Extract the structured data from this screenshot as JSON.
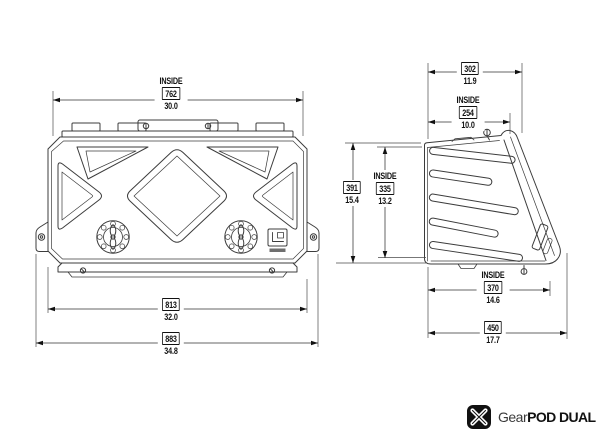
{
  "canvas": {
    "width": 600,
    "height": 448,
    "background": "#ffffff"
  },
  "colors": {
    "line": "#3c3c3c",
    "dim_line": "#333333",
    "text": "#111111"
  },
  "dimensions": {
    "front_inside_width": {
      "prefix": "INSIDE",
      "mm": "762",
      "in": "30.0"
    },
    "front_body_width": {
      "mm": "813",
      "in": "32.0"
    },
    "front_overall_width": {
      "mm": "883",
      "in": "34.8"
    },
    "side_top_depth": {
      "mm": "302",
      "in": "11.9"
    },
    "side_inside_top_depth": {
      "prefix": "INSIDE",
      "mm": "254",
      "in": "10.0"
    },
    "side_overall_height": {
      "mm": "391",
      "in": "15.4"
    },
    "side_inside_height": {
      "prefix": "INSIDE",
      "mm": "335",
      "in": "13.2"
    },
    "side_inside_depth": {
      "prefix": "INSIDE",
      "mm": "370",
      "in": "14.6"
    },
    "side_overall_depth": {
      "mm": "450",
      "in": "17.7"
    }
  },
  "branding": {
    "brand_regular": "Gear",
    "brand_bold": "POD DUAL"
  }
}
